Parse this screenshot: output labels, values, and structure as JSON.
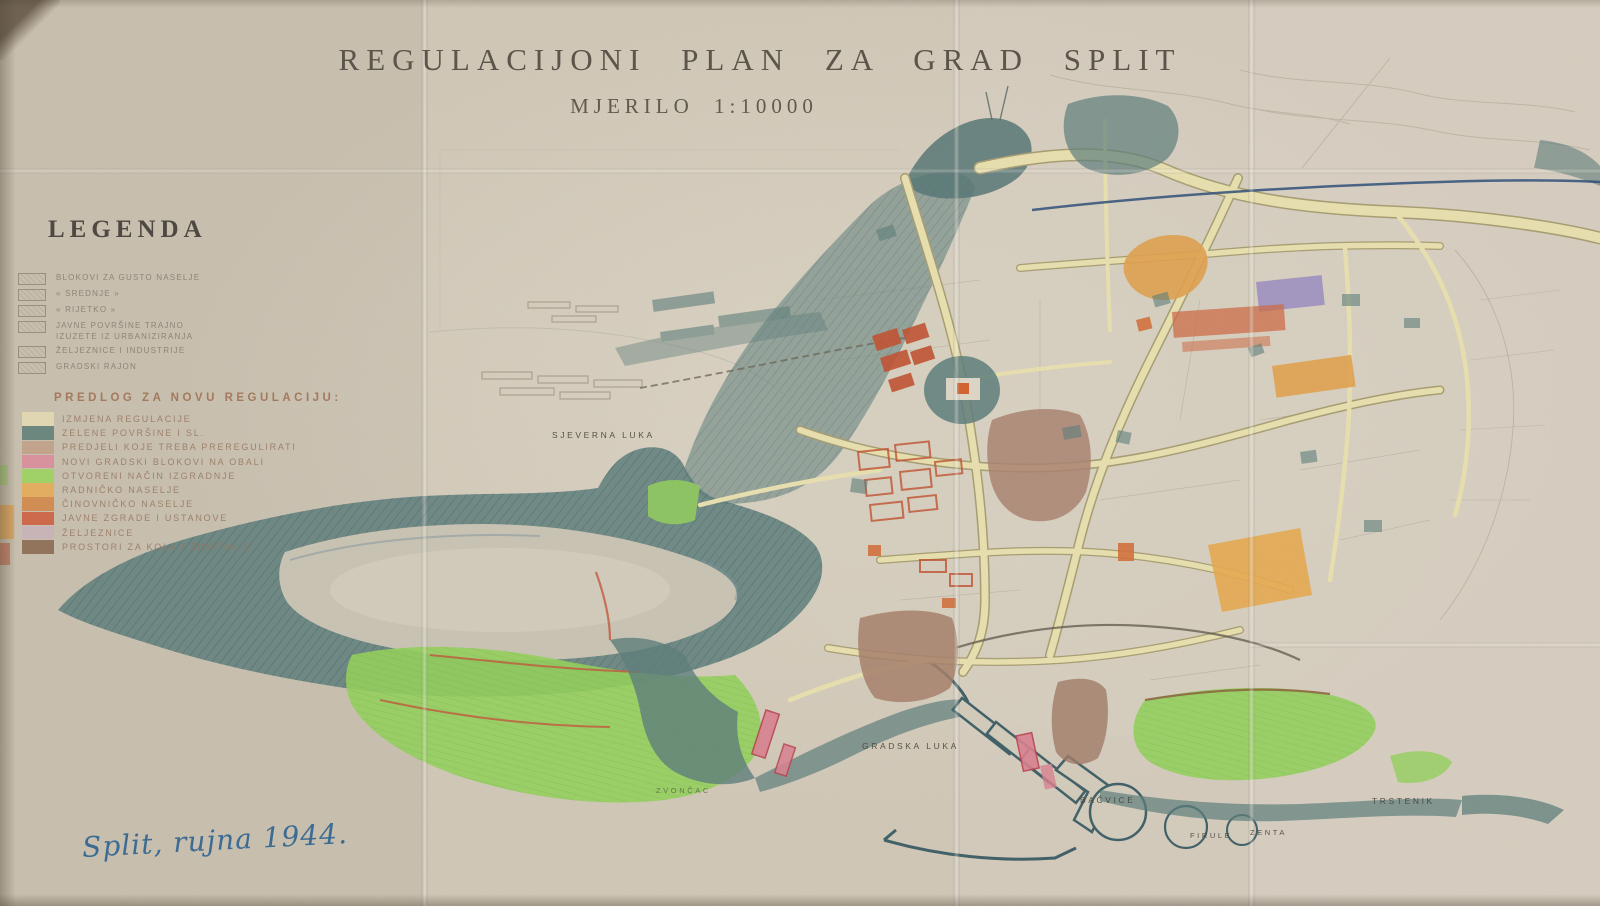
{
  "title": {
    "main": "REGULACIJONI PLAN ZA GRAD SPLIT",
    "scale": "MJERILO 1:10000"
  },
  "legend": {
    "heading": "LEGENDA",
    "existing_items": [
      {
        "label": "BLOKOVI ZA GUSTO NASELJE"
      },
      {
        "label": "«  SREDNJE  »"
      },
      {
        "label": "«  RIJETKO  »"
      },
      {
        "label": "JAVNE POVRŠINE TRAJNO\nIZUZETE IZ URBANIZIRANJA"
      },
      {
        "label": "ŽELJEZNICE I INDUSTRIJE"
      },
      {
        "label": "GRADSKI RAJON"
      }
    ],
    "proposal_heading": "PREDLOG ZA NOVU REGULACIJU:",
    "proposal_items": [
      {
        "label": "IZMJENA REGULACIJE",
        "color": "#e2dab2"
      },
      {
        "label": "ZELENE POVRŠINE I SL.",
        "color": "#5e7f77"
      },
      {
        "label": "PREDJELI KOJE TREBA PREREGULIRATI",
        "color": "#c0a188"
      },
      {
        "label": "NOVI GRADSKI BLOKOVI NA OBALI",
        "color": "#d98c9c"
      },
      {
        "label": "OTVORENI NAČIN IZGRADNJE",
        "color": "#9bd35f"
      },
      {
        "label": "RADNIČKO NASELJE",
        "color": "#e6ab55"
      },
      {
        "label": "ČINOVNIČKO NASELJE",
        "color": "#d08648"
      },
      {
        "label": "JAVNE ZGRADE I USTANOVE",
        "color": "#cc5f3d"
      },
      {
        "label": "ŽELJEZNICE",
        "color": "#c7b3b8"
      },
      {
        "label": "PROSTORI ZA KOLA I ŽIVOTINJE",
        "color": "#8a6a52"
      }
    ]
  },
  "map_labels": [
    {
      "id": "sjeverna-luka",
      "text": "SJEVERNA LUKA"
    },
    {
      "id": "gradska-luka",
      "text": "GRADSKA LUKA"
    },
    {
      "id": "zvoncac",
      "text": "ZVONČAC"
    },
    {
      "id": "bacvice",
      "text": "BAČVICE"
    },
    {
      "id": "firule",
      "text": "FIRULE"
    },
    {
      "id": "zenta",
      "text": "ZENTA"
    },
    {
      "id": "trstenik",
      "text": "TRSTENIK"
    }
  ],
  "annotation": {
    "date_note": "Split, rujna 1944."
  },
  "palette": {
    "paper": "#cfc6b5",
    "hill_teal": "#5d7d7a",
    "slope_green": "#93cf5c",
    "road_cream": "#e8dfae",
    "road_edge": "#a79d72",
    "block_red": "#c05231",
    "district_brown": "#a98270",
    "patch_orange": "#e2a14c",
    "patch_purple": "#9a8cc0",
    "patch_pink": "#d9808f",
    "ink_blue": "#2e4d78",
    "handwriting_blue": "#3c6b94"
  }
}
